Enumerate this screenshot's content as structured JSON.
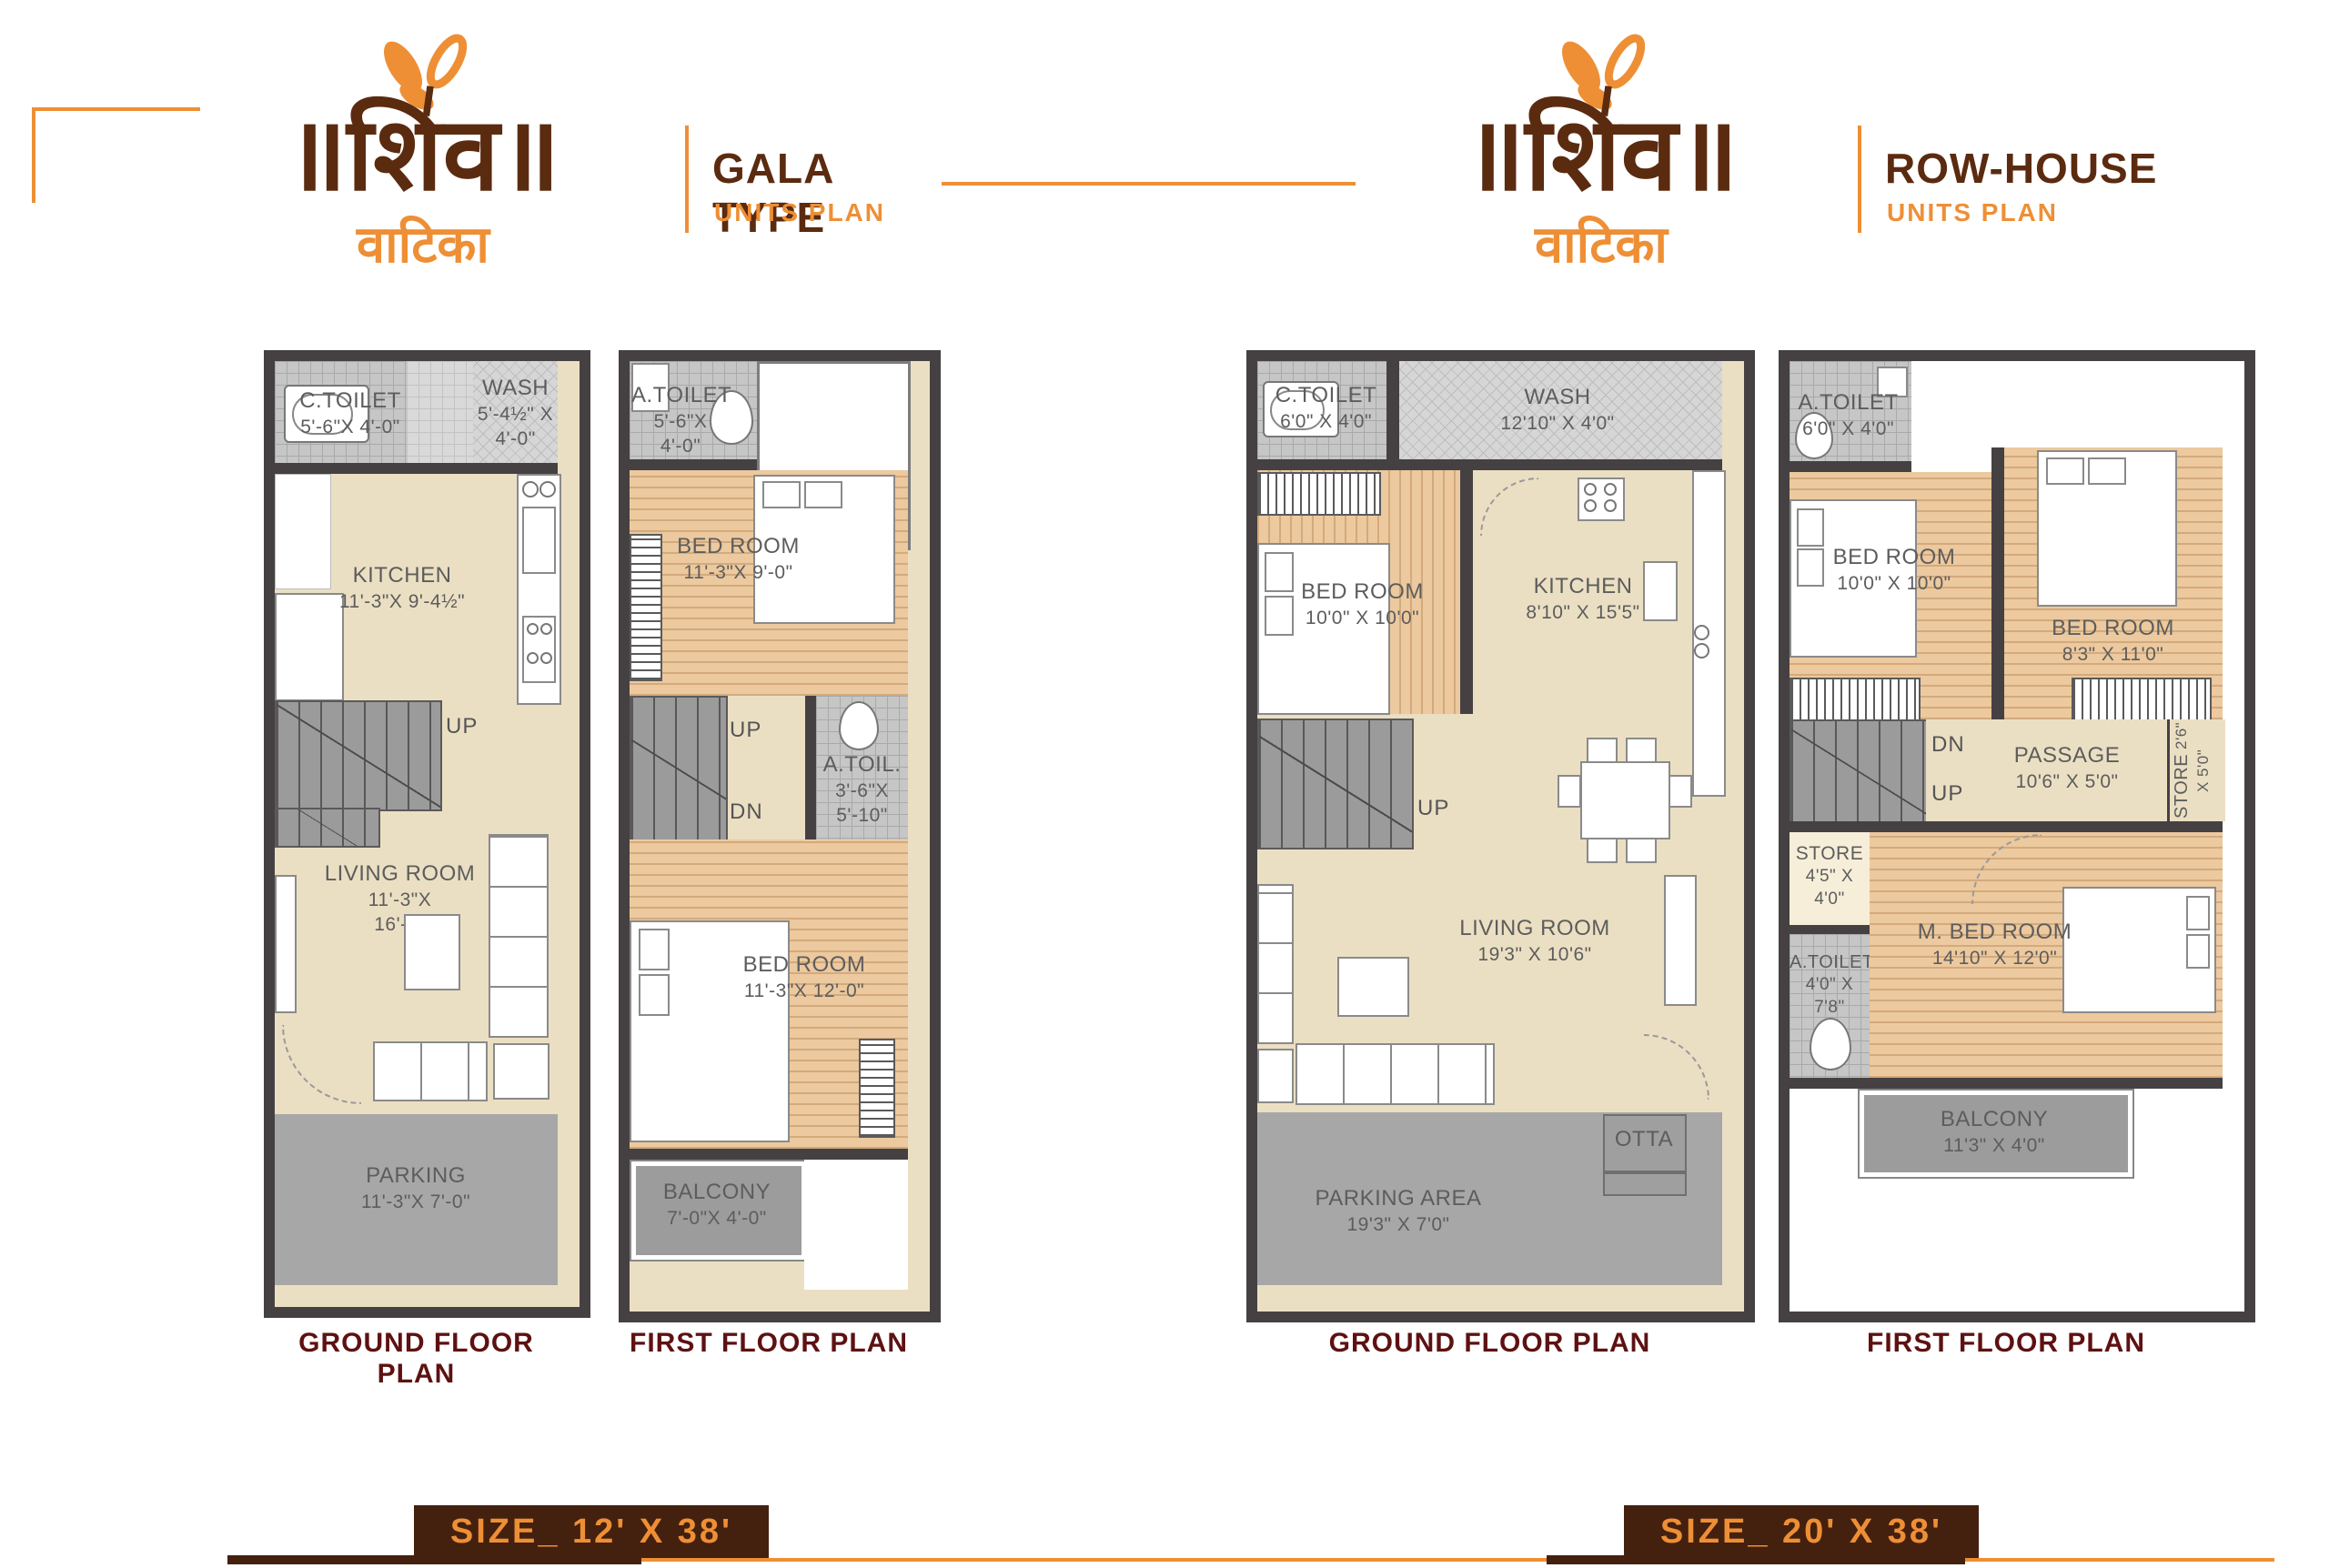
{
  "brand": {
    "logo_text": "॥शिव॥",
    "logo_sub": "वाटिका"
  },
  "header": {
    "gala": {
      "title": "GALA TYPE",
      "subtitle": "UNITS PLAN"
    },
    "rowhouse": {
      "title": "ROW-HOUSE",
      "subtitle": "UNITS PLAN"
    }
  },
  "plans": {
    "gala_ground": {
      "label": "GROUND FLOOR PLAN",
      "rooms": {
        "c_toilet": {
          "name": "C.TOILET",
          "dim1": "5'-6\"X 4'-0\""
        },
        "wash": {
          "name": "WASH",
          "dim1": "5'-4½\" X",
          "dim2": "4'-0\""
        },
        "kitchen": {
          "name": "KITCHEN",
          "dim1": "11'-3\"X 9'-4½\""
        },
        "up": "UP",
        "living": {
          "name": "LIVING ROOM",
          "dim1": "11'-3\"X",
          "dim2": "16'-6\""
        },
        "parking": {
          "name": "PARKING",
          "dim1": "11'-3\"X 7'-0\""
        }
      }
    },
    "gala_first": {
      "label": "FIRST FLOOR PLAN",
      "rooms": {
        "a_toilet": {
          "name": "A.TOILET",
          "dim1": "5'-6\"X",
          "dim2": "4'-0\""
        },
        "bedroom1": {
          "name": "BED ROOM",
          "dim1": "11'-3\"X 9'-0\""
        },
        "up": "UP",
        "dn": "DN",
        "a_toil": {
          "name": "A.TOIL.",
          "dim1": "3'-6\"X",
          "dim2": "5'-10\""
        },
        "bedroom2": {
          "name": "BED ROOM",
          "dim1": "11'-3\"X 12'-0\""
        },
        "balcony": {
          "name": "BALCONY",
          "dim1": "7'-0\"X 4'-0\""
        }
      }
    },
    "row_ground": {
      "label": "GROUND FLOOR PLAN",
      "rooms": {
        "c_toilet": {
          "name": "C.TOILET",
          "dim1": "6'0\" X 4'0\""
        },
        "wash": {
          "name": "WASH",
          "dim1": "12'10\" X 4'0\""
        },
        "bedroom": {
          "name": "BED ROOM",
          "dim1": "10'0\" X 10'0\""
        },
        "kitchen": {
          "name": "KITCHEN",
          "dim1": "8'10\" X 15'5\""
        },
        "up": "UP",
        "living": {
          "name": "LIVING ROOM",
          "dim1": "19'3\" X 10'6\""
        },
        "otta": "OTTA",
        "parking": {
          "name": "PARKING AREA",
          "dim1": "19'3\" X 7'0\""
        }
      }
    },
    "row_first": {
      "label": "FIRST FLOOR PLAN",
      "rooms": {
        "a_toilet": {
          "name": "A.TOILET",
          "dim1": "6'0\" X 4'0\""
        },
        "bedroom1": {
          "name": "BED ROOM",
          "dim1": "10'0\" X 10'0\""
        },
        "bedroom2": {
          "name": "BED ROOM",
          "dim1": "8'3\" X 11'0\""
        },
        "dn": "DN",
        "up": "UP",
        "passage": {
          "name": "PASSAGE",
          "dim1": "10'6\" X 5'0\""
        },
        "store_v": {
          "name": "STORE",
          "dim1": "2'6\" X 5'0\""
        },
        "store": {
          "name": "STORE",
          "dim1": "4'5\" X",
          "dim2": "4'0\""
        },
        "a_toilet2": {
          "name": "A.TOILET",
          "dim1": "4'0\" X",
          "dim2": "7'8\""
        },
        "m_bedroom": {
          "name": "M. BED ROOM",
          "dim1": "14'10\" X 12'0\""
        },
        "balcony": {
          "name": "BALCONY",
          "dim1": "11'3\" X 4'0\""
        }
      }
    }
  },
  "sizes": {
    "gala": "SIZE_ 12' X 38'",
    "rowhouse": "SIZE_ 20' X 38'"
  },
  "colors": {
    "accent_orange": "#ee8f35",
    "brand_brown": "#5b2b10",
    "label_maroon": "#5e1111",
    "badge_bg": "#44200f",
    "wall": "#454142"
  }
}
